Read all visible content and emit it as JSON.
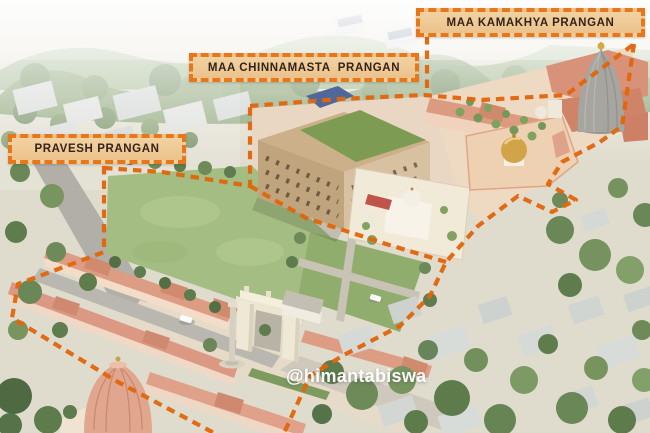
{
  "labels": [
    {
      "id": "pravesh-prangan",
      "text": "PRAVESH PRANGAN"
    },
    {
      "id": "chinnamasta-prangan",
      "text": "MAA CHINNAMASTA  PRANGAN"
    },
    {
      "id": "kamakhya-prangan",
      "text": "MAA KAMAKHYA PRANGAN"
    }
  ],
  "watermark": {
    "text": "@himantabiswa"
  },
  "colors": {
    "label_background": "#ecc28b",
    "label_border": "#e8771c",
    "label_text": "#33231a",
    "boundary_dash": "#e2660c",
    "roof_terracotta": "#db9a7f",
    "lawn_green": "#a4bd82",
    "watermark_text": "#ffffff"
  }
}
